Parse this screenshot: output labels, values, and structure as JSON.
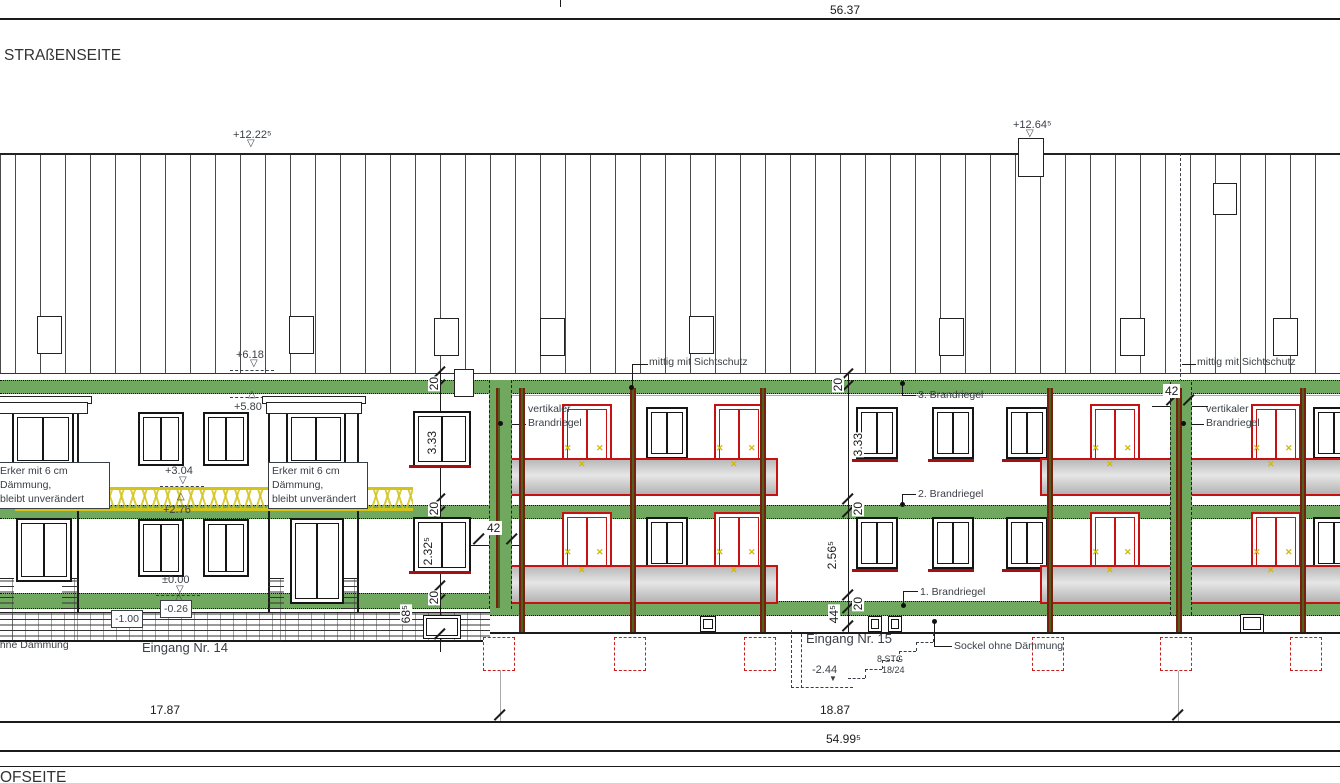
{
  "drawing": {
    "side_label_top": "STRAßENSEITE",
    "side_label_bottom": "OFSEITE",
    "dims": {
      "total_top": "56.37",
      "seg_left": "17.87",
      "seg_mid": "18.87",
      "total_bottom": "54.99⁵",
      "strip_left_width": "42",
      "strip_right_width": "42",
      "chain_left": [
        "20",
        "3.33",
        "20",
        "2.32⁵",
        "20",
        "68⁵"
      ],
      "chain_right": [
        "20",
        "3.33",
        "20",
        "2.56⁵",
        "20",
        "44⁵"
      ]
    },
    "levels": {
      "ridge": "+12.22⁵",
      "chimney": "+12.64⁵",
      "eaves": "+6.18",
      "band3_bottom": "+5.80",
      "upper_floor": "+3.04",
      "band2_top": "+2.76",
      "ground_floor": "±0.00",
      "band1": "-0.26",
      "base": "-1.00",
      "basement": "-2.44"
    },
    "notes": {
      "erker": "Erker mit 6 cm\nDämmung,\nbleibt unverändert",
      "sichtschutz": "mittig mit Sichtschutz",
      "vertikal_brandriegel": "vertikaler\nBrandriegel",
      "brandriegel3": "3. Brandriegel",
      "brandriegel2": "2. Brandriegel",
      "brandriegel1": "1. Brandriegel",
      "sockel": "Sockel ohne Dämmung",
      "ohne_daemmung": "ohne Dämmung",
      "entrance14": "Eingang Nr. 14",
      "entrance15": "Eingang Nr. 15",
      "stairs_steps": "8 STG",
      "stairs_ratio": "18/24"
    },
    "icons": {
      "triangle_down": "▽",
      "triangle_up": "△",
      "triangle_down_filled": "▼",
      "x_mark": "✕"
    },
    "colors": {
      "brandriegel_green": "#6fa85e",
      "renovation_red": "#c41111",
      "ornament_yellow": "#d3c41d",
      "balcony_gray": "#c9c9c9"
    }
  }
}
